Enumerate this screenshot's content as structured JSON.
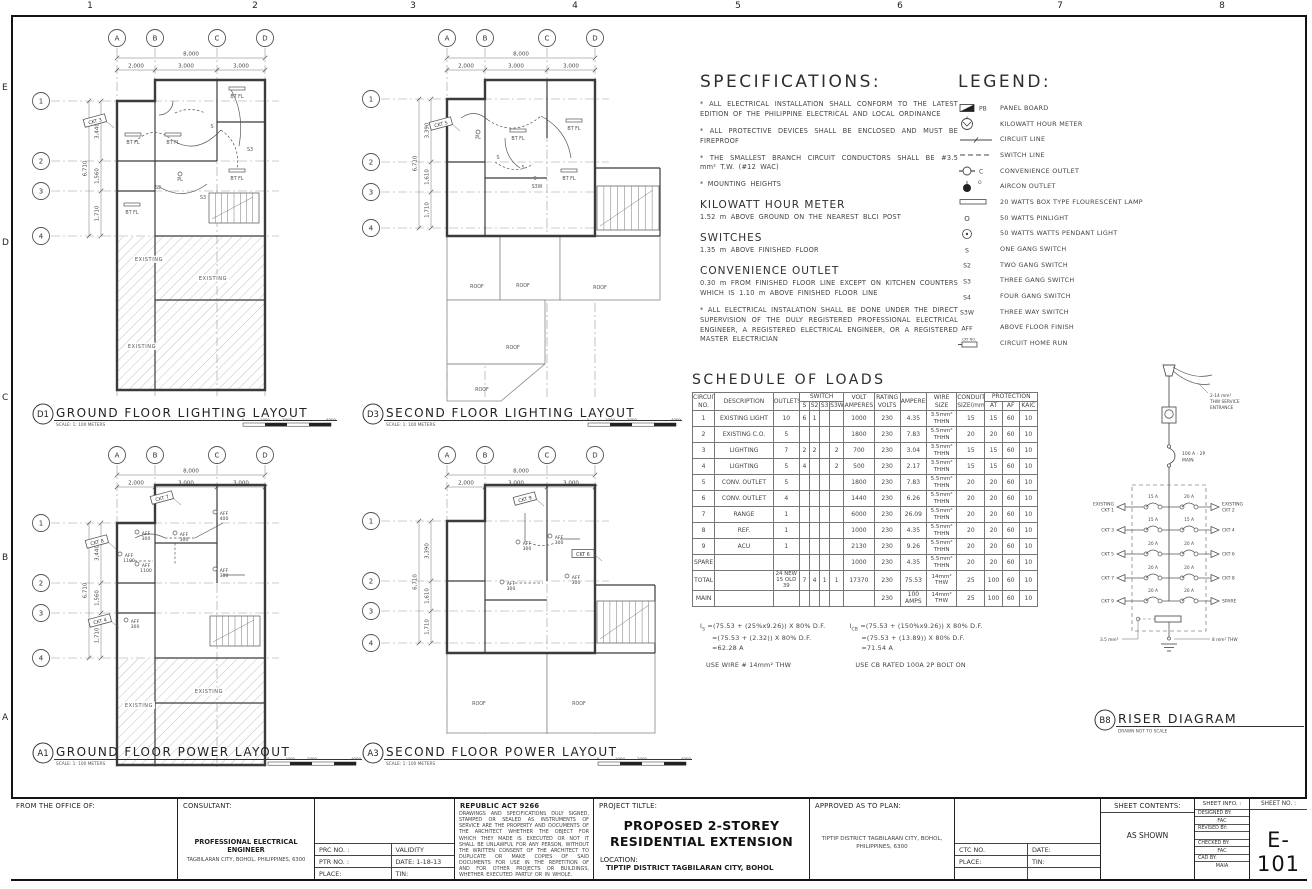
{
  "sheet": {
    "ruler_top": [
      "1",
      "2",
      "3",
      "4",
      "5",
      "6",
      "7",
      "8"
    ],
    "ruler_left": [
      "E",
      "D",
      "C",
      "B",
      "A"
    ]
  },
  "plan_grid": {
    "cols": [
      "A",
      "B",
      "C",
      "D"
    ],
    "rows": [
      "1",
      "2",
      "3",
      "4"
    ],
    "dim_top_total": "8,000",
    "dims_top": [
      "2,000",
      "3,000",
      "3,000"
    ],
    "dim_left_total": "6,710"
  },
  "plans": {
    "d1": {
      "tag": "D1",
      "title": "GROUND FLOOR LIGHTING LAYOUT",
      "scale": "SCALE: 1: 100 METERS",
      "dims_left": [
        "3,440",
        "1,560",
        "1,710"
      ],
      "scalebar": [
        "0",
        "1000",
        "2000",
        "4000"
      ],
      "annotations": [
        {
          "t": "CKT 3",
          "x": 70,
          "y": 103,
          "r": -15,
          "box": true
        },
        {
          "t": "BT FL",
          "x": 108,
          "y": 126
        },
        {
          "t": "BT FL",
          "x": 148,
          "y": 126
        },
        {
          "t": "BT FL",
          "x": 212,
          "y": 80
        },
        {
          "t": "BT FL",
          "x": 212,
          "y": 162
        },
        {
          "t": "BT FL",
          "x": 107,
          "y": 196
        },
        {
          "t": "PL",
          "x": 155,
          "y": 163
        },
        {
          "t": "S2",
          "x": 133,
          "y": 171
        },
        {
          "t": "S",
          "x": 187,
          "y": 110
        },
        {
          "t": "S3",
          "x": 225,
          "y": 133
        },
        {
          "t": "S3",
          "x": 178,
          "y": 181
        },
        {
          "t": "EXISTING",
          "x": 124,
          "y": 243
        },
        {
          "t": "EXISTING",
          "x": 188,
          "y": 262
        },
        {
          "t": "EXISTING",
          "x": 117,
          "y": 330
        }
      ]
    },
    "d3": {
      "tag": "D3",
      "title": "SECOND FLOOR LIGHTING LAYOUT",
      "scale": "SCALE: 1: 100 METERS",
      "dims_left": [
        "3,390",
        "1,610",
        "1,710"
      ],
      "scalebar": [
        "0",
        "1000",
        "2000",
        "4000"
      ],
      "annotations": [
        {
          "t": "CKT 5",
          "x": 86,
          "y": 106,
          "r": -15,
          "box": true
        },
        {
          "t": "PL",
          "x": 123,
          "y": 121
        },
        {
          "t": "BT FL",
          "x": 163,
          "y": 122
        },
        {
          "t": "BT FL",
          "x": 219,
          "y": 112
        },
        {
          "t": "BT FL",
          "x": 214,
          "y": 162
        },
        {
          "t": "S",
          "x": 143,
          "y": 141
        },
        {
          "t": "S",
          "x": 168,
          "y": 151
        },
        {
          "t": "S",
          "x": 180,
          "y": 162
        },
        {
          "t": "S3W",
          "x": 182,
          "y": 170
        },
        {
          "t": "ROOF",
          "x": 122,
          "y": 270
        },
        {
          "t": "ROOF",
          "x": 168,
          "y": 269
        },
        {
          "t": "ROOF",
          "x": 245,
          "y": 271
        },
        {
          "t": "ROOF",
          "x": 158,
          "y": 331
        },
        {
          "t": "ROOF",
          "x": 127,
          "y": 373
        }
      ]
    },
    "a1": {
      "tag": "A1",
      "title": "GROUND FLOOR POWER LAYOUT",
      "scale": "SCALE: 1: 100 METERS",
      "dims_left": [
        "3,440",
        "1,560",
        "1,710"
      ],
      "scalebar": [
        "0",
        "1000",
        "2000",
        "4000"
      ],
      "annotations": [
        {
          "t": "CKT 7",
          "x": 137,
          "y": 63,
          "r": -15,
          "box": true
        },
        {
          "t": "CKT 8",
          "x": 72,
          "y": 107,
          "r": -15,
          "box": true
        },
        {
          "t": "CKT 4",
          "x": 75,
          "y": 186,
          "r": -15,
          "box": true
        },
        {
          "t": "AFF 300",
          "x": 121,
          "y": 100
        },
        {
          "t": "AFF 300",
          "x": 159,
          "y": 101
        },
        {
          "t": "AFF 400",
          "x": 199,
          "y": 80
        },
        {
          "t": "AFF 1100",
          "x": 104,
          "y": 122
        },
        {
          "t": "AFF 1100",
          "x": 121,
          "y": 132
        },
        {
          "t": "AFF 300",
          "x": 199,
          "y": 137
        },
        {
          "t": "AFF 300",
          "x": 110,
          "y": 188
        },
        {
          "t": "EXISTING",
          "x": 184,
          "y": 258
        },
        {
          "t": "EXISTING",
          "x": 114,
          "y": 272
        }
      ]
    },
    "a3": {
      "tag": "A3",
      "title": "SECOND FLOOR POWER LAYOUT",
      "scale": "SCALE: 1: 100 METERS",
      "dims_left": [
        "3,390",
        "1,610",
        "1,710"
      ],
      "scalebar": [
        "0",
        "1000",
        "2000",
        "4000"
      ],
      "annotations": [
        {
          "t": "CKT 9",
          "x": 170,
          "y": 64,
          "r": -15,
          "box": true
        },
        {
          "t": "CKT 6",
          "x": 228,
          "y": 119,
          "r": 0,
          "box": true
        },
        {
          "t": "AFF 300",
          "x": 204,
          "y": 104
        },
        {
          "t": "AFF 300",
          "x": 172,
          "y": 110
        },
        {
          "t": "AFF 300",
          "x": 221,
          "y": 144
        },
        {
          "t": "AFF 300",
          "x": 156,
          "y": 150
        },
        {
          "t": "ROOF",
          "x": 124,
          "y": 270
        },
        {
          "t": "ROOF",
          "x": 224,
          "y": 270
        }
      ]
    }
  },
  "specifications": {
    "title": "SPECIFICATIONS:",
    "items": [
      "* ALL ELECTRICAL INSTALLATION SHALL CONFORM TO THE LATEST EDITION OF THE PHILIPPINE ELECTRICAL AND LOCAL ORDINANCE",
      "* ALL PROTECTIVE DEVICES SHALL BE ENCLOSED AND MUST BE FIREPROOF",
      "* THE SMALLEST BRANCH CIRCUIT CONDUCTORS SHALL BE #3.5 mm² T.W. (#12 WAC)",
      "* MOUNTING HEIGHTS"
    ],
    "sections": [
      {
        "heading": "KILOWATT HOUR METER",
        "text": "1.52 m ABOVE GROUND ON THE NEAREST BLCI POST"
      },
      {
        "heading": "SWITCHES",
        "text": "1.35 m ABOVE FINISHED FLOOR"
      },
      {
        "heading": "CONVENIENCE OUTLET",
        "text": "0.30 m FROM FINISHED FLOOR LINE EXCEPT ON KITCHEN COUNTERS WHICH IS 1.10 m ABOVE FINISHED FLOOR LINE"
      }
    ],
    "footer": "* ALL ELECTRICAL INSTALATION SHALL BE DONE UNDER THE DIRECT SUPERVISION OF THE DULY REGISTERED PROFESSIONAL ELECTRICAL ENGINEER, A REGISTERED ELECTRICAL ENGINEER, OR A REGISTERED MASTER ELECTRICIAN"
  },
  "legend": {
    "title": "LEGEND:",
    "items": [
      {
        "sym": "panel-board",
        "key": "PB",
        "label": "PANEL BOARD"
      },
      {
        "sym": "kwh-meter",
        "key": "",
        "label": "KILOWATT HOUR METER"
      },
      {
        "sym": "circuit-line",
        "key": "",
        "label": "CIRCUIT LINE"
      },
      {
        "sym": "switch-line",
        "key": "",
        "label": "SWITCH LINE"
      },
      {
        "sym": "convenience-outlet",
        "key": "C",
        "label": "CONVENIENCE OUTLET"
      },
      {
        "sym": "aircon-outlet",
        "key": "O",
        "label": "AIRCON OUTLET"
      },
      {
        "sym": "fluorescent-lamp",
        "key": "",
        "label": "20 WATTS BOX TYPE FLOURESCENT LAMP"
      },
      {
        "sym": "pinlight",
        "key": "O",
        "label": "50 WATTS PINLIGHT"
      },
      {
        "sym": "pendant-light",
        "key": "",
        "label": "50 WATTS WATTS PENDANT LIGHT"
      },
      {
        "sym": "text",
        "key": "S",
        "label": "ONE GANG SWITCH"
      },
      {
        "sym": "text",
        "key": "S2",
        "label": "TWO GANG SWITCH"
      },
      {
        "sym": "text",
        "key": "S3",
        "label": "THREE GANG SWITCH"
      },
      {
        "sym": "text",
        "key": "S4",
        "label": "FOUR GANG SWITCH"
      },
      {
        "sym": "text",
        "key": "S3W",
        "label": "THREE WAY SWITCH"
      },
      {
        "sym": "text",
        "key": "AFF",
        "label": "ABOVE FLOOR FINISH"
      },
      {
        "sym": "home-run",
        "key": "CKT NO.",
        "label": "CIRCUIT HOME RUN"
      }
    ]
  },
  "schedule": {
    "title": "SCHEDULE OF LOADS",
    "header_main": [
      "CIRCUIT NO.",
      "DESCRIPTION",
      "OUTLETS",
      "SWITCH",
      "VOLT AMPERES",
      "RATING VOLTS",
      "AMPERES",
      "WIRE SIZE",
      "CONDUIT SIZE(mm)",
      "PROTECTION"
    ],
    "header_sub": [
      "S",
      "S2",
      "S3",
      "S3W",
      "AT",
      "AF",
      "KAIC"
    ],
    "rows": [
      [
        "1",
        "EXISTING LIGHT",
        "10",
        "6",
        "1",
        "",
        "",
        "1000",
        "230",
        "4.35",
        "3.5mm² THHN",
        "15",
        "15",
        "60",
        "10"
      ],
      [
        "2",
        "EXISTING C.O.",
        "5",
        "",
        "",
        "",
        "",
        "1800",
        "230",
        "7.83",
        "5.5mm² THHN",
        "20",
        "20",
        "60",
        "10"
      ],
      [
        "3",
        "LIGHTING",
        "7",
        "2",
        "2",
        "",
        "2",
        "700",
        "230",
        "3.04",
        "3.5mm² THHN",
        "15",
        "15",
        "60",
        "10"
      ],
      [
        "4",
        "LIGHTING",
        "5",
        "4",
        "",
        "",
        "2",
        "500",
        "230",
        "2.17",
        "3.5mm² THHN",
        "15",
        "15",
        "60",
        "10"
      ],
      [
        "5",
        "CONV. OUTLET",
        "5",
        "",
        "",
        "",
        "",
        "1800",
        "230",
        "7.83",
        "5.5mm² THHN",
        "20",
        "20",
        "60",
        "10"
      ],
      [
        "6",
        "CONV. OUTLET",
        "4",
        "",
        "",
        "",
        "",
        "1440",
        "230",
        "6.26",
        "5.5mm² THHN",
        "20",
        "20",
        "60",
        "10"
      ],
      [
        "7",
        "RANGE",
        "1",
        "",
        "",
        "",
        "",
        "6000",
        "230",
        "26.09",
        "5.5mm² THHN",
        "20",
        "20",
        "60",
        "10"
      ],
      [
        "8",
        "REF.",
        "1",
        "",
        "",
        "",
        "",
        "1000",
        "230",
        "4.35",
        "5.5mm² THHN",
        "20",
        "20",
        "60",
        "10"
      ],
      [
        "9",
        "ACU",
        "1",
        "",
        "",
        "",
        "",
        "2130",
        "230",
        "9.26",
        "5.5mm² THHN",
        "20",
        "20",
        "60",
        "10"
      ],
      [
        "SPARE",
        "",
        "",
        "",
        "",
        "",
        "",
        "1000",
        "230",
        "4.35",
        "5.5mm² THHN",
        "20",
        "20",
        "60",
        "10"
      ],
      [
        "TOTAL",
        "",
        "24 NEW|15 OLD|39",
        "7",
        "4",
        "1",
        "1",
        "17370",
        "230",
        "75.53",
        "14mm² THW",
        "25",
        "100",
        "60",
        "10"
      ],
      [
        "MAIN",
        "",
        "",
        "",
        "",
        "",
        "",
        "",
        "230",
        "100 AMPS",
        "14mm² THW",
        "25",
        "100",
        "60",
        "10"
      ]
    ]
  },
  "calculations": {
    "left": {
      "sub": "S",
      "lines": [
        "=(75.53 + (25%x9.26)) X 80% D.F.",
        "=(75.53 + (2.32)) X 80% D.F.",
        "=62.28 A"
      ],
      "use": "USE WIRE # 14mm² THW"
    },
    "right": {
      "sub": "CB",
      "lines": [
        "=(75.53 + (150%x9.26)) X 80% D.F.",
        "=(75.53 + (13.89)) X 80% D.F.",
        "=71.54 A"
      ],
      "use": "USE CB RATED 100A  2P BOLT ON"
    }
  },
  "riser": {
    "tag": "B8",
    "title": "RISER DIAGRAM",
    "subtitle": "DRAWN NOT TO SCALE",
    "service_label": [
      "2-14 mm²",
      "THW SERVICE",
      "ENTRANCE"
    ],
    "main_label": [
      "100 A - 2P",
      "MAIN"
    ],
    "ground_left": "3.5 mm²",
    "ground_right": "8 mm² THW",
    "rows": [
      {
        "ll": "EXISTING CKT 1",
        "la": "15 A",
        "ra": "20 A",
        "rl": "EXISTING CKT 2"
      },
      {
        "ll": "CKT 3",
        "la": "15 A",
        "ra": "15 A",
        "rl": "CKT 4"
      },
      {
        "ll": "CKT 5",
        "la": "20 A",
        "ra": "20 A",
        "rl": "CKT 6"
      },
      {
        "ll": "CKT 7",
        "la": "20 A",
        "ra": "20 A",
        "rl": "CKT 8"
      },
      {
        "ll": "CKT 9",
        "la": "20 A",
        "ra": "20 A",
        "rl": "SPARE"
      }
    ]
  },
  "title_block": {
    "office_label": "FROM THE OFFICE OF:",
    "consultant_label": "CONSULTANT:",
    "consultant_name": "PROFESSIONAL ELECTRICAL ENGINEER",
    "consultant_address": "TAGBILARAN CITY, BOHOL, PHILIPPINES, 6300",
    "prc_label": "PRC NO. :",
    "validity_label": "VALIDITY",
    "ptr_label": "PTR NO. :",
    "date_label": "DATE:  1-18-13",
    "place_label": "PLACE:",
    "tin_label": "TIN:",
    "ra_title": "REPUBLIC ACT 9266",
    "ra_text": "DRAWINGS AND SPECIFICATIONS DULY SIGNED, STAMPED OR SEALED AS INSTRUMENTS OF SERVICE ARE THE PROPERTY AND DOCUMENTS OF THE ARCHITECT WHETHER THE OBJECT FOR WHICH THEY MADE IS EXECUTED OR NOT IT SHALL BE UNLAWFUL FOR ANY PERSON, WITHOUT THE WRITTEN CONSENT OF THE ARCHITECT TO DUPLICATE OR MAKE COPIES OF SAID DOCUMENTS FOR USE IN THE REPETITION OF AND FOR OTHER PROJECTS OR BUILDINGS, WHETHER EXECUTED PARTLY OR IN WHOLE.",
    "project_label": "PROJECT TILTLE:",
    "project_title": "PROPOSED 2-STOREY RESIDENTIAL EXTENSION",
    "location_label": "LOCATION:",
    "location": "TIPTIP DISTRICT TAGBILARAN CITY, BOHOL",
    "approved_label": "APPROVED AS TO PLAN:",
    "approved_text": "TIPTIP DISTRICT TAGBILARAN CITY, BOHOL, PHILIPPINES, 6300",
    "ctc_label": "CTC NO.",
    "date2_label": "DATE:",
    "place2_label": "PLACE:",
    "tin2_label": "TIN:",
    "sheet_contents_label": "SHEET CONTENTS:",
    "sheet_contents": "AS SHOWN",
    "sheet_info_label": "SHEET INFO. :",
    "info_rows": [
      {
        "k": "DESIGNED BY:",
        "v": "FAC"
      },
      {
        "k": "REVISED BY:",
        "v": ""
      },
      {
        "k": "CHECKED BY:",
        "v": "FAC"
      },
      {
        "k": "CAD BY:",
        "v": "MAIA"
      }
    ],
    "sheet_no_label": "SHEET NO. :",
    "sheet_no": "E-101"
  }
}
